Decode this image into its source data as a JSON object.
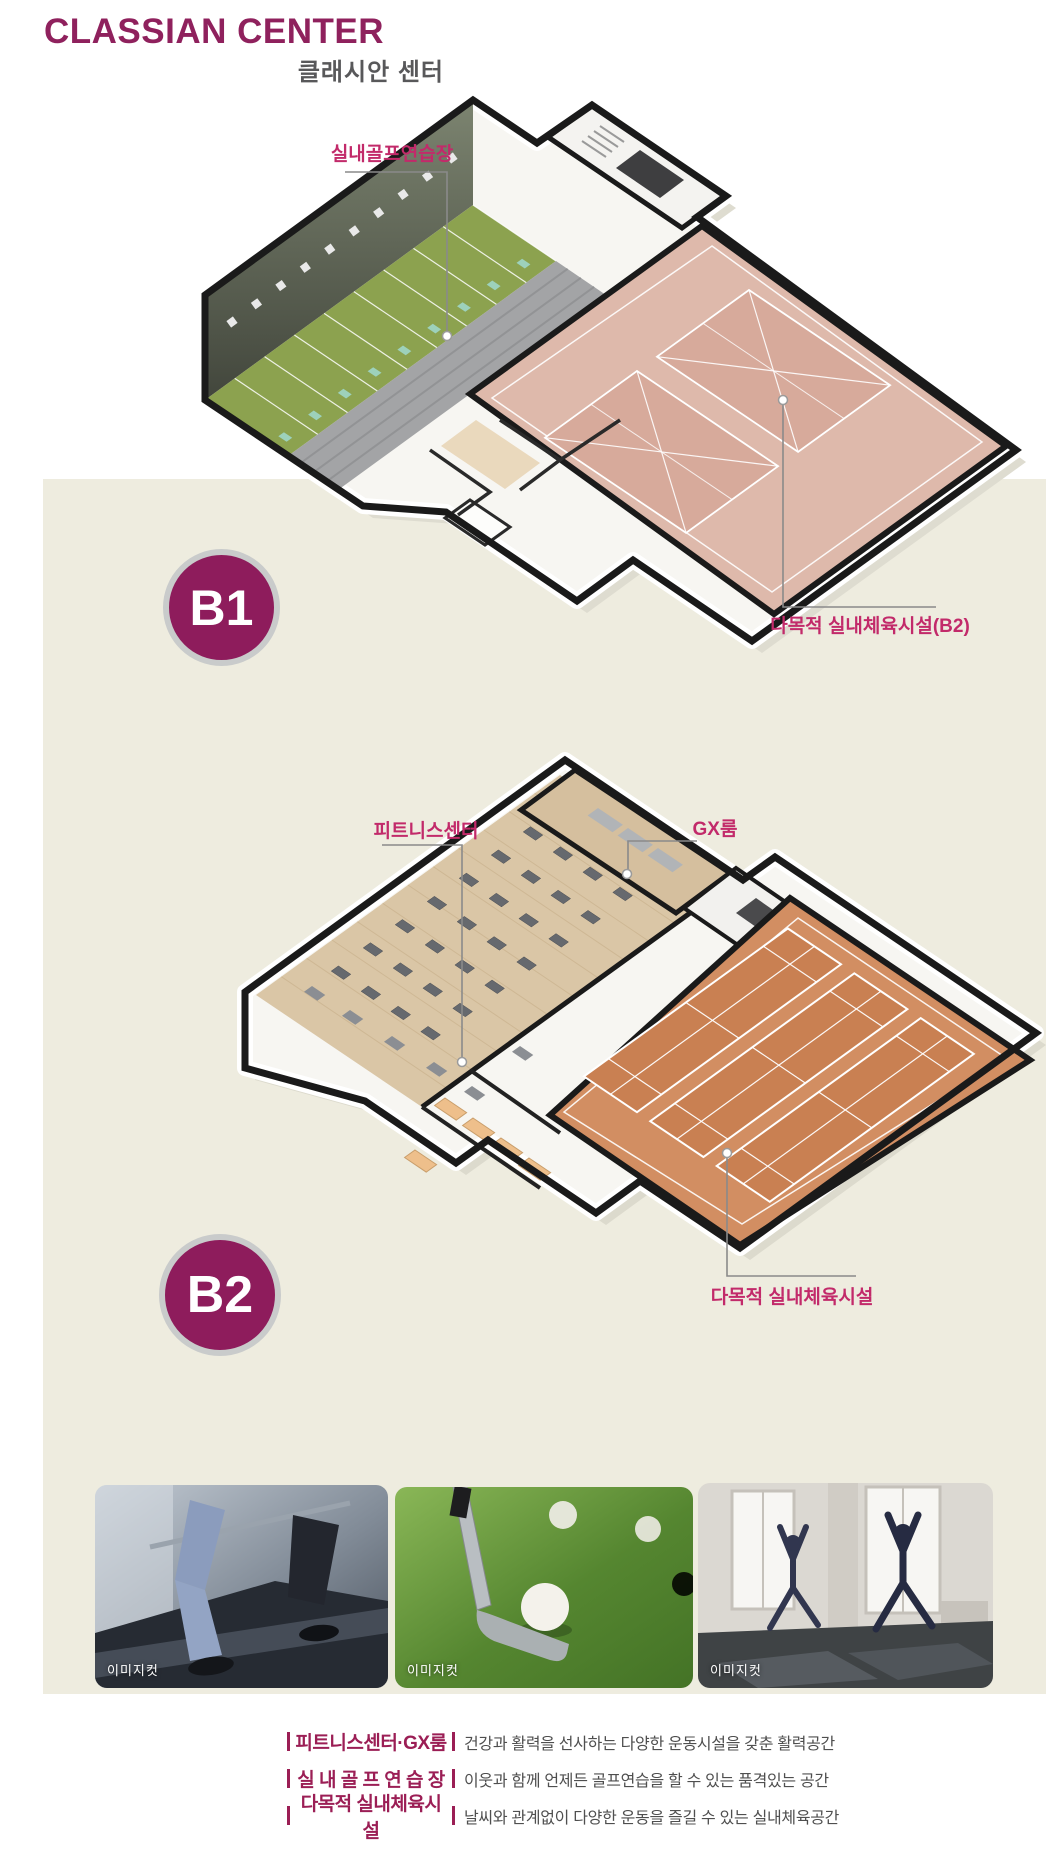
{
  "header": {
    "title_en": "CLASSIAN CENTER",
    "title_ko": "클래시안 센터"
  },
  "floor_b1": {
    "badge": "B1",
    "label_golf": "실내골프연습장",
    "label_court": "다목적 실내체육시설(B2)"
  },
  "floor_b2": {
    "badge": "B2",
    "label_fitness": "피트니스센터",
    "label_gx": "GX룸",
    "label_court": "다목적 실내체육시설"
  },
  "photos": [
    {
      "caption": "이미지컷",
      "subject": "fitness-treadmill"
    },
    {
      "caption": "이미지컷",
      "subject": "golf-club-and-balls"
    },
    {
      "caption": "이미지컷",
      "subject": "yoga-class"
    }
  ],
  "legend": {
    "items": [
      {
        "term": "피트니스센터·GX룸",
        "desc": "건강과 활력을 선사하는 다양한 운동시설을 갖춘 활력공간"
      },
      {
        "term": "실 내 골 프 연 습 장",
        "desc": "이웃과 함께 언제든 골프연습을 할 수 있는 품격있는 공간"
      },
      {
        "term": "다목적 실내체육시설",
        "desc": "날씨와 관계없이 다양한 운동을 즐길 수 있는 실내체육공간"
      }
    ]
  },
  "colors": {
    "brand": "#8f215d",
    "label_pink": "#c22a6a",
    "legend_term": "#9b1e55",
    "badge": "#8e1c5c",
    "beige_panel": "#eeecdf",
    "golf_green": "#8ca24f",
    "court_pink": "#deb9ab",
    "court_orange": "#d28e62",
    "wood_floor": "#dac6a6"
  }
}
